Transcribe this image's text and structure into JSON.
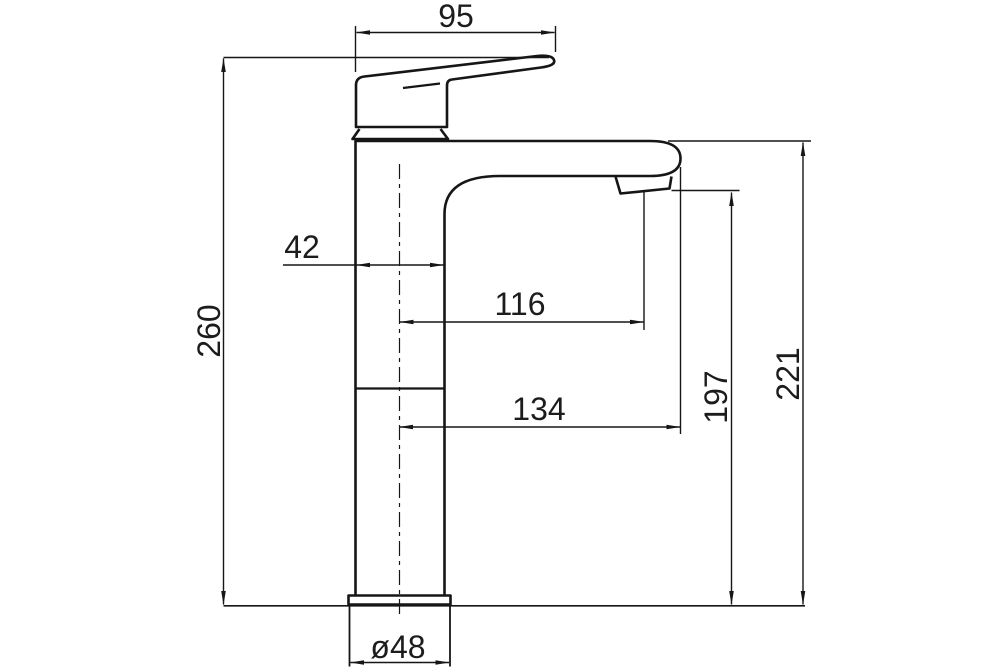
{
  "diagram": {
    "type": "technical-drawing",
    "subject": "basin mixer tap side elevation with dimensions",
    "colors": {
      "background": "#ffffff",
      "line": "#161616",
      "text": "#1c1c1c"
    },
    "labels": {
      "handle_length": "95",
      "overall_height": "260",
      "body_width": "42",
      "aerator_reach": "116",
      "spout_reach": "134",
      "aerator_height": "197",
      "spout_height": "221",
      "base_diameter": "ø48"
    }
  }
}
